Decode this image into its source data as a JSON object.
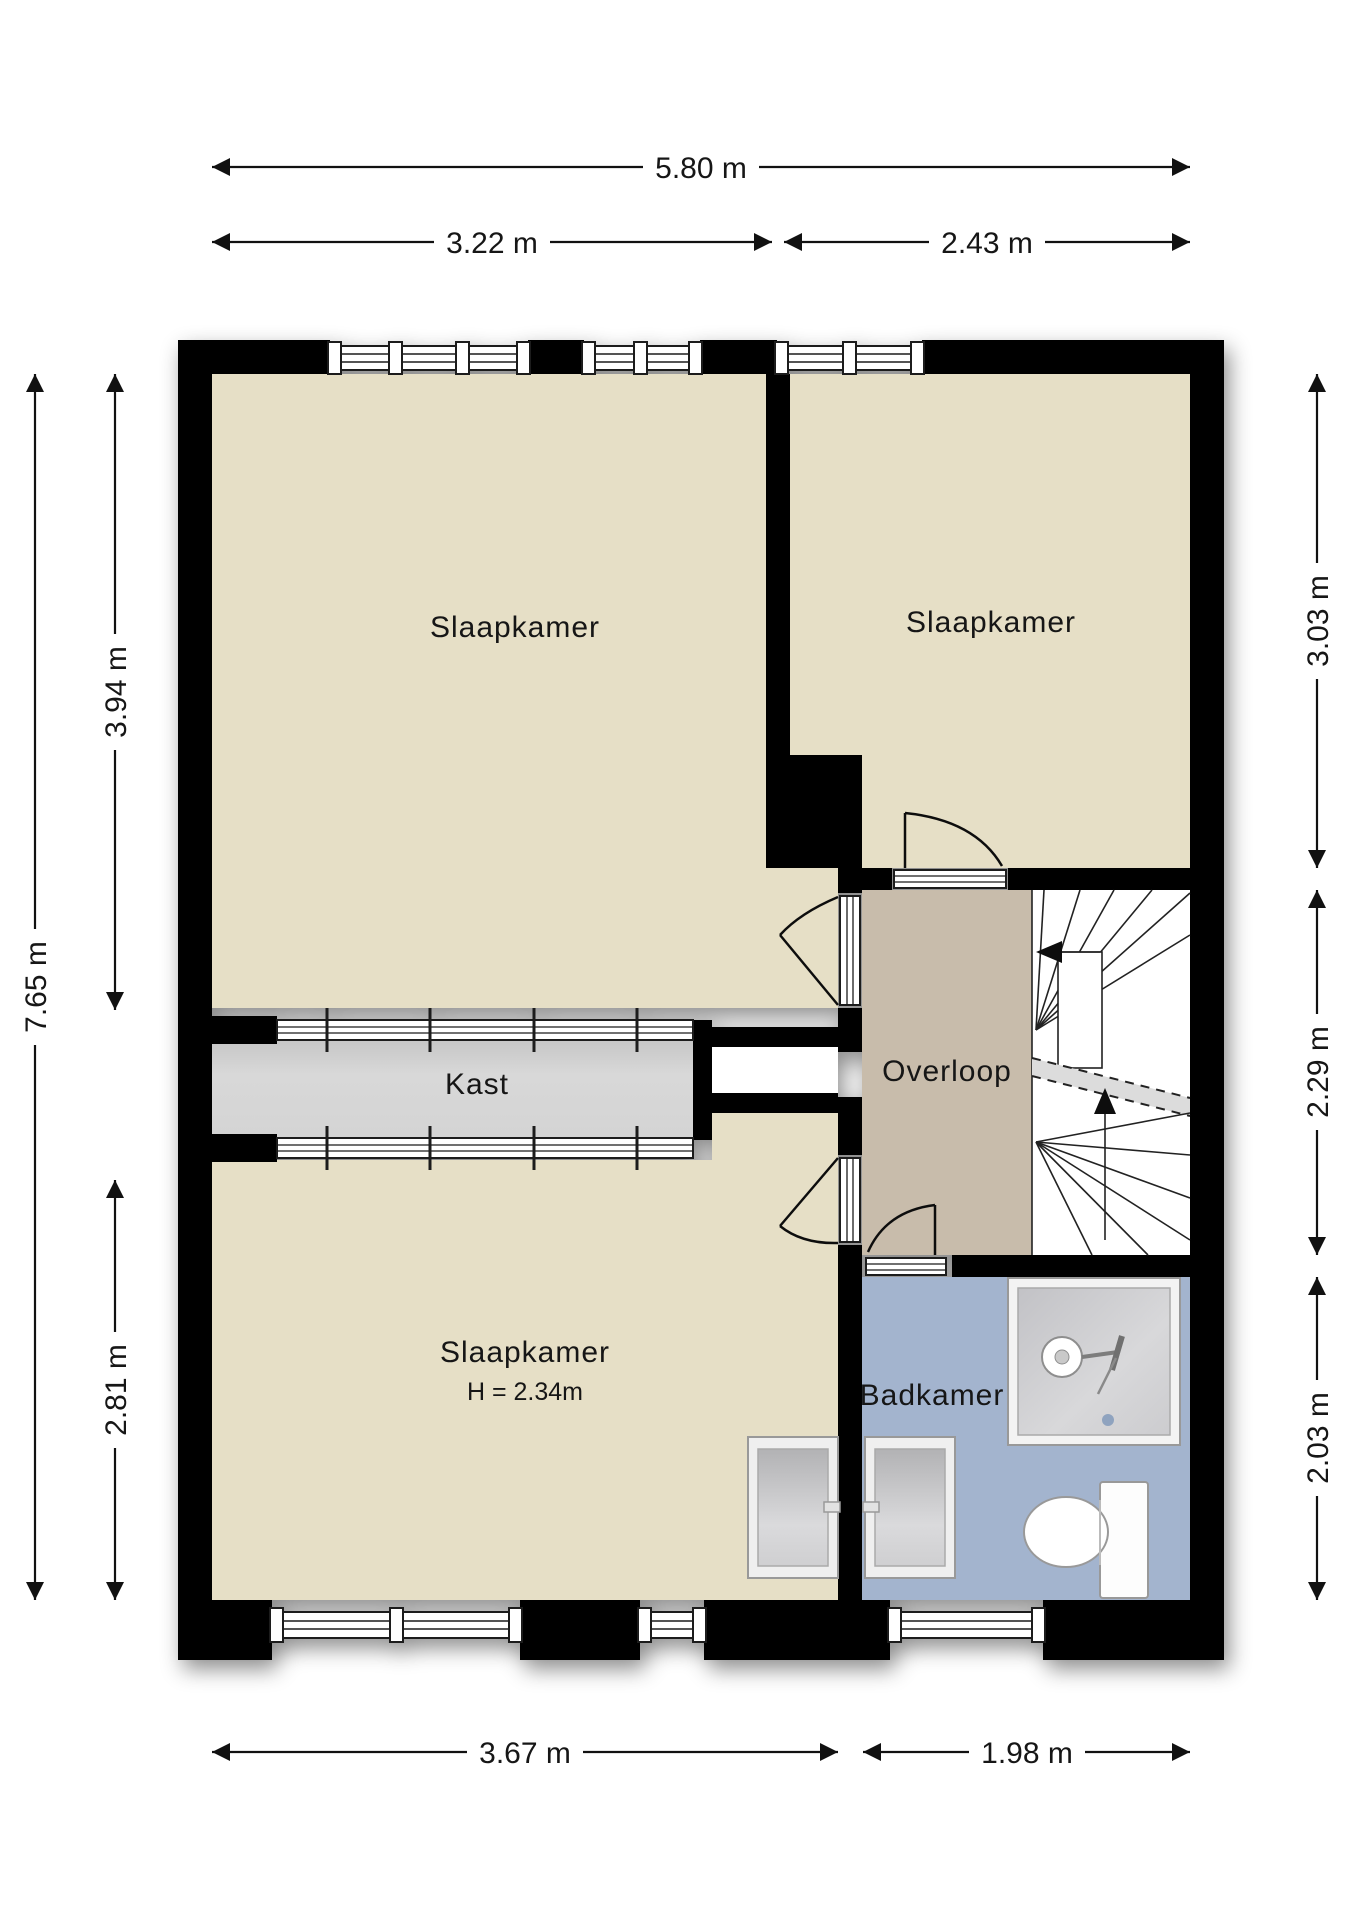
{
  "plan": {
    "type": "floorplan",
    "language": "nl",
    "colors": {
      "wall": "#000000",
      "bedroom_floor": "#e6dfc6",
      "closet_floor": "#d6d6d6",
      "landing_floor": "#c8bcab",
      "bathroom_floor": "#a3b4ce",
      "stairs_floor": "#ffffff",
      "fixture_grey": "#d0d0d2",
      "drain_blue": "#8fa3bf",
      "text": "#161616"
    },
    "rooms": [
      {
        "id": "slaapkamer-top-left",
        "label": "Slaapkamer"
      },
      {
        "id": "slaapkamer-top-right",
        "label": "Slaapkamer"
      },
      {
        "id": "kast",
        "label": "Kast"
      },
      {
        "id": "overloop",
        "label": "Overloop"
      },
      {
        "id": "slaapkamer-bottom",
        "label": "Slaapkamer",
        "sublabel": "H = 2.34m"
      },
      {
        "id": "badkamer",
        "label": "Badkamer"
      }
    ],
    "dimensions": {
      "top": [
        {
          "label": "5.80 m"
        },
        {
          "label": "3.22 m"
        },
        {
          "label": "2.43 m"
        }
      ],
      "bottom": [
        {
          "label": "3.67 m"
        },
        {
          "label": "1.98 m"
        }
      ],
      "left": [
        {
          "label": "7.65 m"
        },
        {
          "label": "3.94 m"
        },
        {
          "label": "2.81 m"
        }
      ],
      "right": [
        {
          "label": "3.03 m"
        },
        {
          "label": "2.29 m"
        },
        {
          "label": "2.03 m"
        }
      ]
    },
    "fixtures": [
      "stairs",
      "stairs-direction-arrows",
      "shower",
      "toilet",
      "radiator-bedroom",
      "radiator-bathroom",
      "closet-front",
      "doors",
      "windows"
    ]
  }
}
